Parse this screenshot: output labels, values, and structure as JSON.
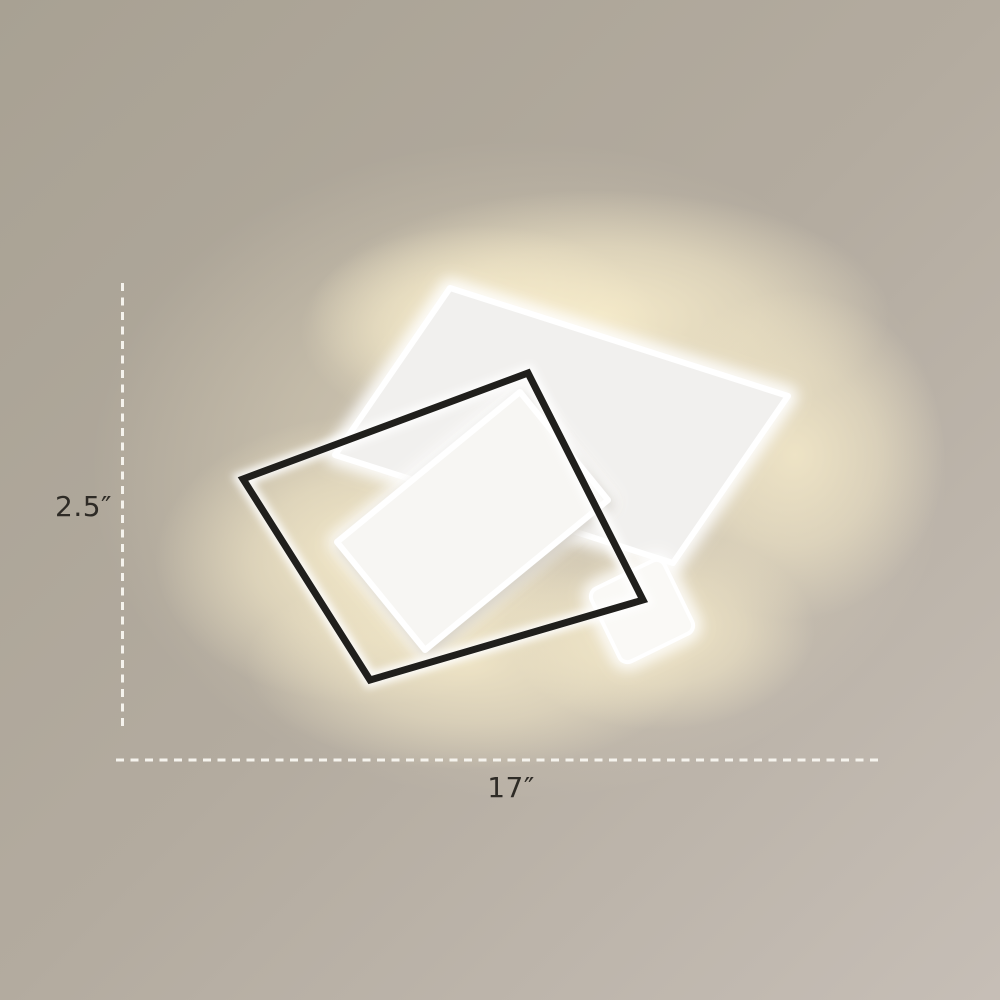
{
  "annotations": {
    "height_label": "2.5″",
    "width_label": "17″"
  },
  "scene": {
    "parts": [
      "large-white-light-panel",
      "black-square-frame",
      "inner-white-light-panel",
      "small-white-light-panel",
      "warm-backlight-glow",
      "height-dimension-line",
      "width-dimension-line"
    ]
  },
  "colors": {
    "background_top_left": "#a8a193",
    "background_mid": "#b3ab9f",
    "background_bottom_right": "#c6beb6",
    "warm_glow": "#f7eccb",
    "panel_large": "#f1f0ee",
    "panel_inner": "#f7f6f3",
    "panel_small": "#faf9f6",
    "panel_rim": "#ffffff",
    "frame_black": "#201f1c",
    "dash_line": "#f5f3ed",
    "label_text": "#2e2b26"
  }
}
